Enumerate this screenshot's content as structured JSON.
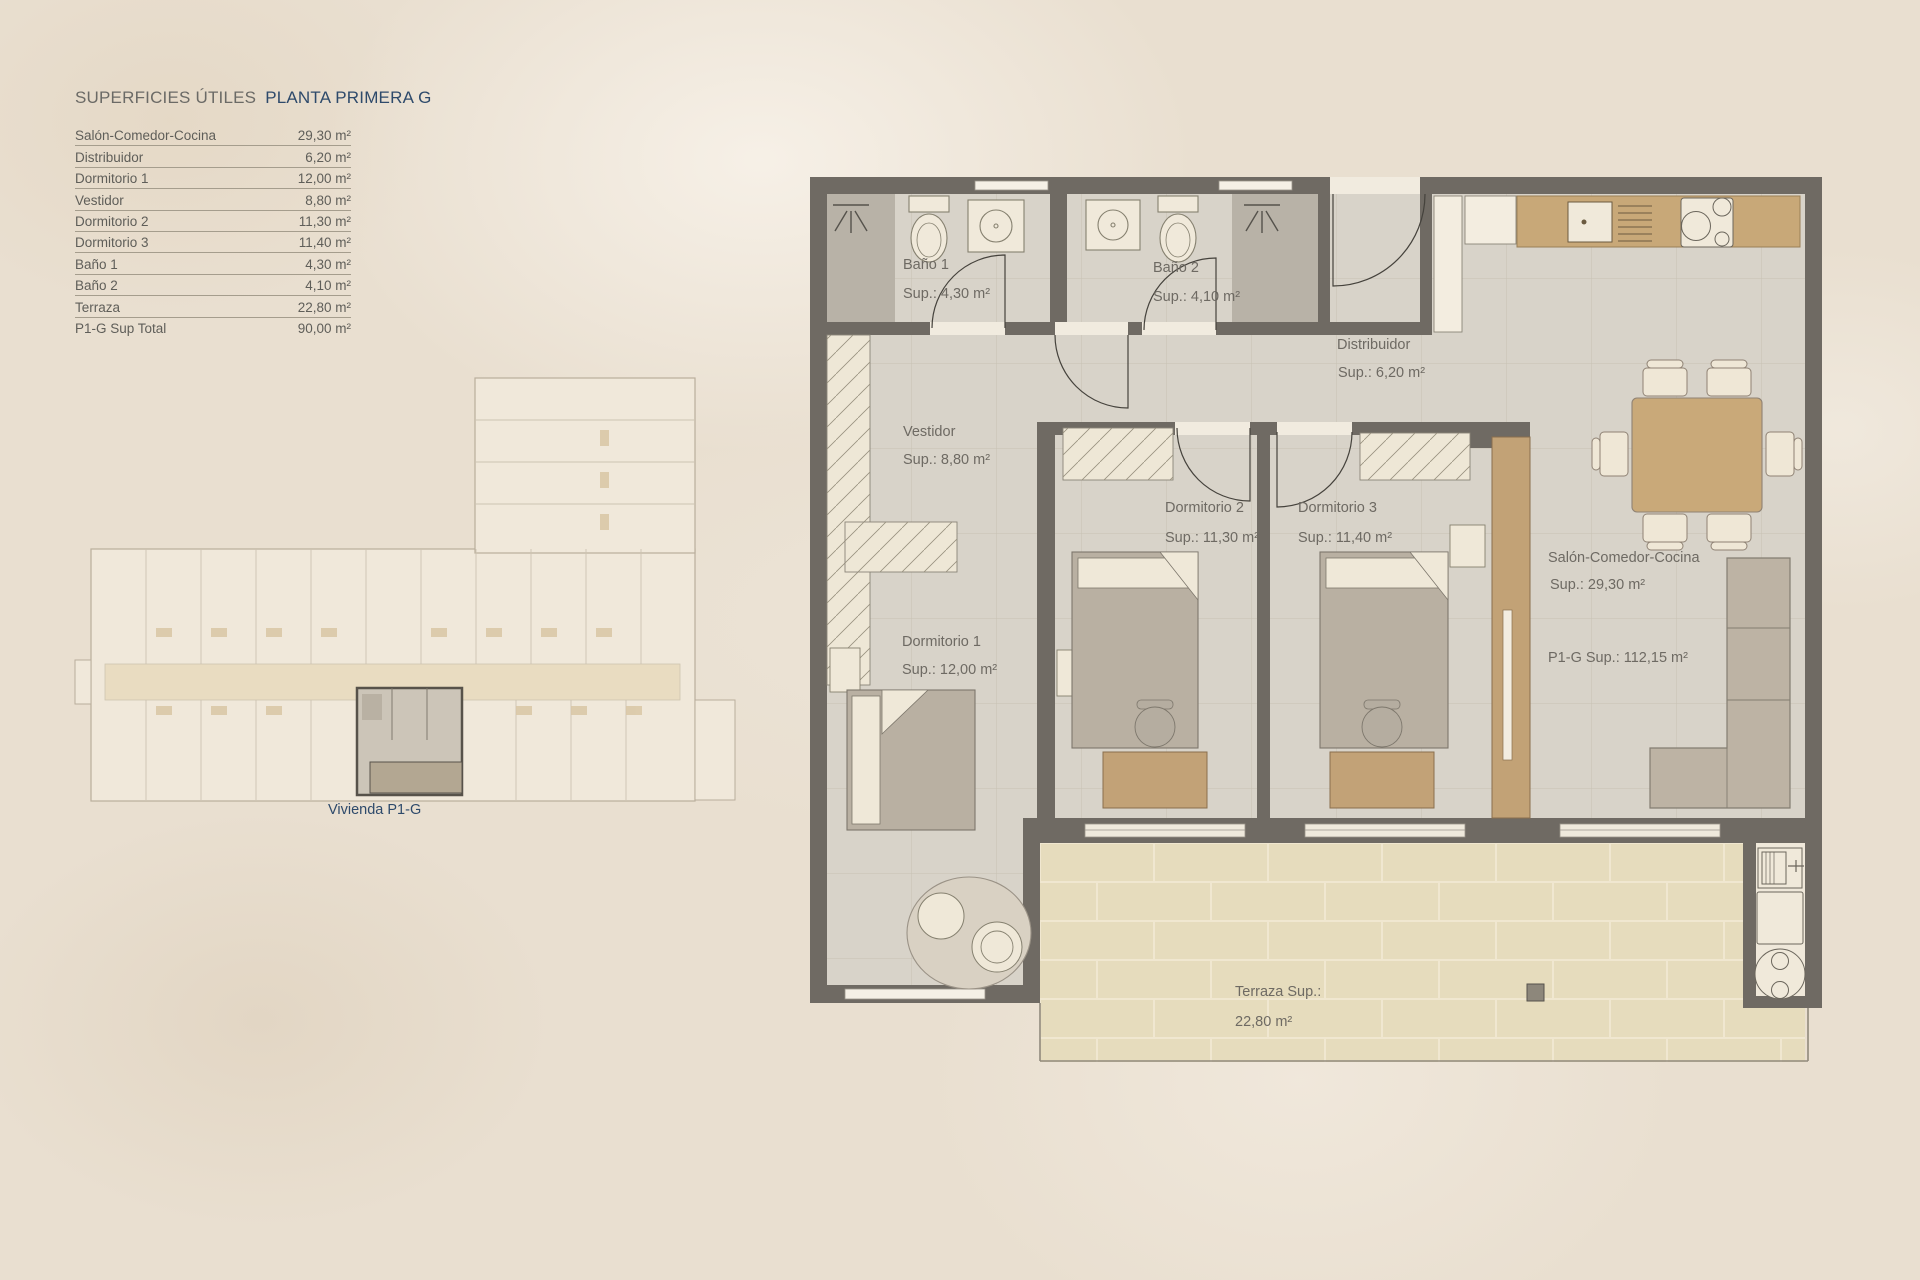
{
  "legend": {
    "title_left": "SUPERFICIES ÚTILES",
    "title_right": "PLANTA PRIMERA  G",
    "rows": [
      {
        "label": "Salón-Comedor-Cocina",
        "value": "29,30 m²"
      },
      {
        "label": "Distribuidor",
        "value": "6,20 m²"
      },
      {
        "label": "Dormitorio 1",
        "value": "12,00 m²"
      },
      {
        "label": "Vestidor",
        "value": "8,80 m²"
      },
      {
        "label": "Dormitorio 2",
        "value": "11,30 m²"
      },
      {
        "label": "Dormitorio 3",
        "value": "11,40 m²"
      },
      {
        "label": "Baño 1",
        "value": "4,30 m²"
      },
      {
        "label": "Baño 2",
        "value": "4,10 m²"
      },
      {
        "label": "Terraza",
        "value": "22,80 m²"
      },
      {
        "label": "P1-G Sup Total",
        "value": "90,00 m²"
      }
    ]
  },
  "overview": {
    "caption": "Vivienda P1-G"
  },
  "rooms": {
    "bano1": {
      "name": "Baño 1",
      "sup": "Sup.: 4,30  m²"
    },
    "bano2": {
      "name": "Baño 2",
      "sup": "Sup.: 4,10 m²"
    },
    "distribuidor": {
      "name": "Distribuidor",
      "sup": "Sup.: 6,20 m²"
    },
    "vestidor": {
      "name": "Vestidor",
      "sup": "Sup.: 8,80 m²"
    },
    "dorm1": {
      "name": "Dormitorio 1",
      "sup": "Sup.: 12,00 m²"
    },
    "dorm2": {
      "name": "Dormitorio 2",
      "sup": "Sup.: 11,30 m²"
    },
    "dorm3": {
      "name": "Dormitorio 3",
      "sup": "Sup.: 11,40 m²"
    },
    "salon": {
      "name": "Salón-Comedor-Cocina",
      "sup": "Sup.: 29,30 m²"
    },
    "total": {
      "name": "P1-G Sup.: 112,15 m²"
    },
    "terraza": {
      "name": "Terraza Sup.:",
      "sup": "22,80 m²"
    }
  },
  "colors": {
    "background": "#e9dfd0",
    "accent_navy": "#2e4a6b",
    "text_gray": "#6e6a63",
    "wall": "#6f6a63",
    "floor_tile": "#d8d3c9",
    "terrace_tile": "#e6dcbd",
    "wood": "#c8a878",
    "furniture_cream": "#efe8d8",
    "mattress": "#b9b0a2"
  }
}
